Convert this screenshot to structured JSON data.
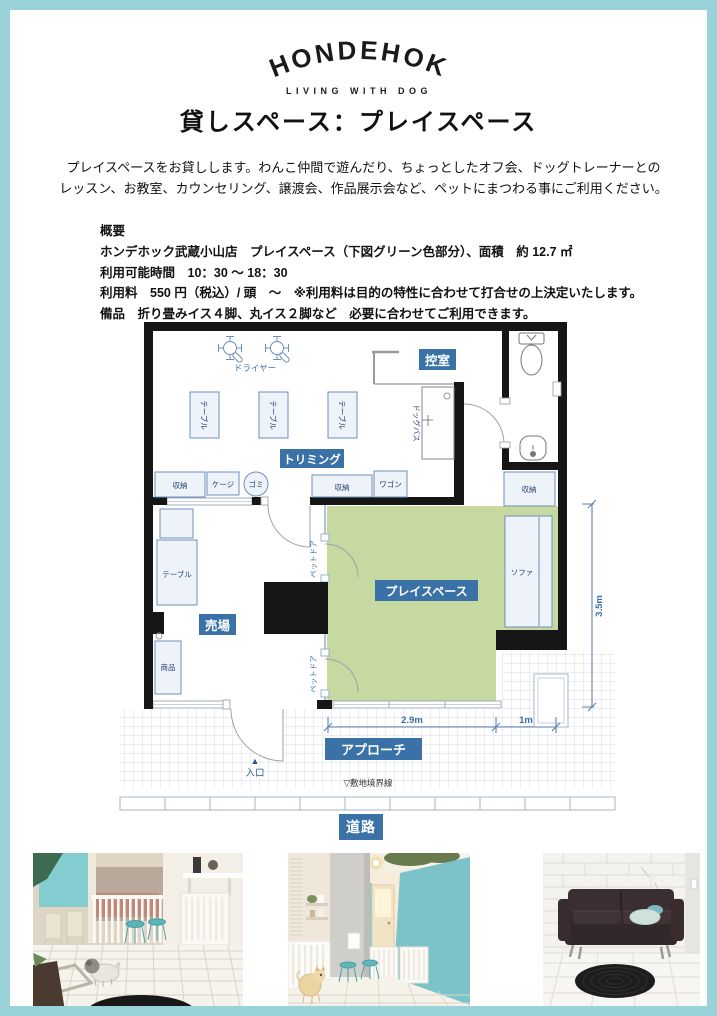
{
  "page": {
    "border_color": "#9ad2da"
  },
  "brand": {
    "name": "HONDEHOK",
    "tagline": "LIVING WITH DOG"
  },
  "title": "貸しスペース：プレイスペース",
  "intro": {
    "line1": "プレイスペースをお貸しします。わんこ仲間で遊んだり、ちょっとしたオフ会、ドッグトレーナーとの",
    "line2": "レッスン、お教室、カウンセリング、譲渡会、作品展示会など、ペットにまつわる事にご利用ください。"
  },
  "overview": {
    "heading": "概要",
    "line1": "ホンデホック武蔵小山店　プレイスペース（下図グリーン色部分）、面積　約 12.7 ㎡",
    "line2": "利用可能時間　10：30 ～ 18：30",
    "line3": "利用料　550 円（税込）/ 頭　～　※利用料は目的の特性に合わせて打合せの上決定いたします。",
    "line4": "備品　折り畳みイス４脚、丸イス２脚など　必要に合わせてご利用できます。"
  },
  "floorplan": {
    "colors": {
      "play_space_green": "#c5d9a0",
      "label_blue": "#3a72a8",
      "wall": "#161616",
      "border_teal": "#9ad2da"
    },
    "labels": {
      "dryer": "ドライヤー",
      "table": "テーブル",
      "trimming": "トリミング",
      "storage": "収納",
      "cage": "ケージ",
      "trash": "ゴミ",
      "wagon": "ワゴン",
      "waiting_room": "控室",
      "dog_bath": "ドッグバス",
      "pet_door": "ペットドア",
      "play_space": "プレイスペース",
      "sofa": "ソファ",
      "sales_floor": "売場",
      "products": "商品",
      "approach": "アプローチ",
      "entrance_marker": "▲",
      "entrance": "入口",
      "boundary": "▽敷地境界線"
    },
    "dimensions": {
      "play_width": "2.9m",
      "nook_width": "1m",
      "play_height": "3.5m"
    }
  },
  "road_label": "道路"
}
